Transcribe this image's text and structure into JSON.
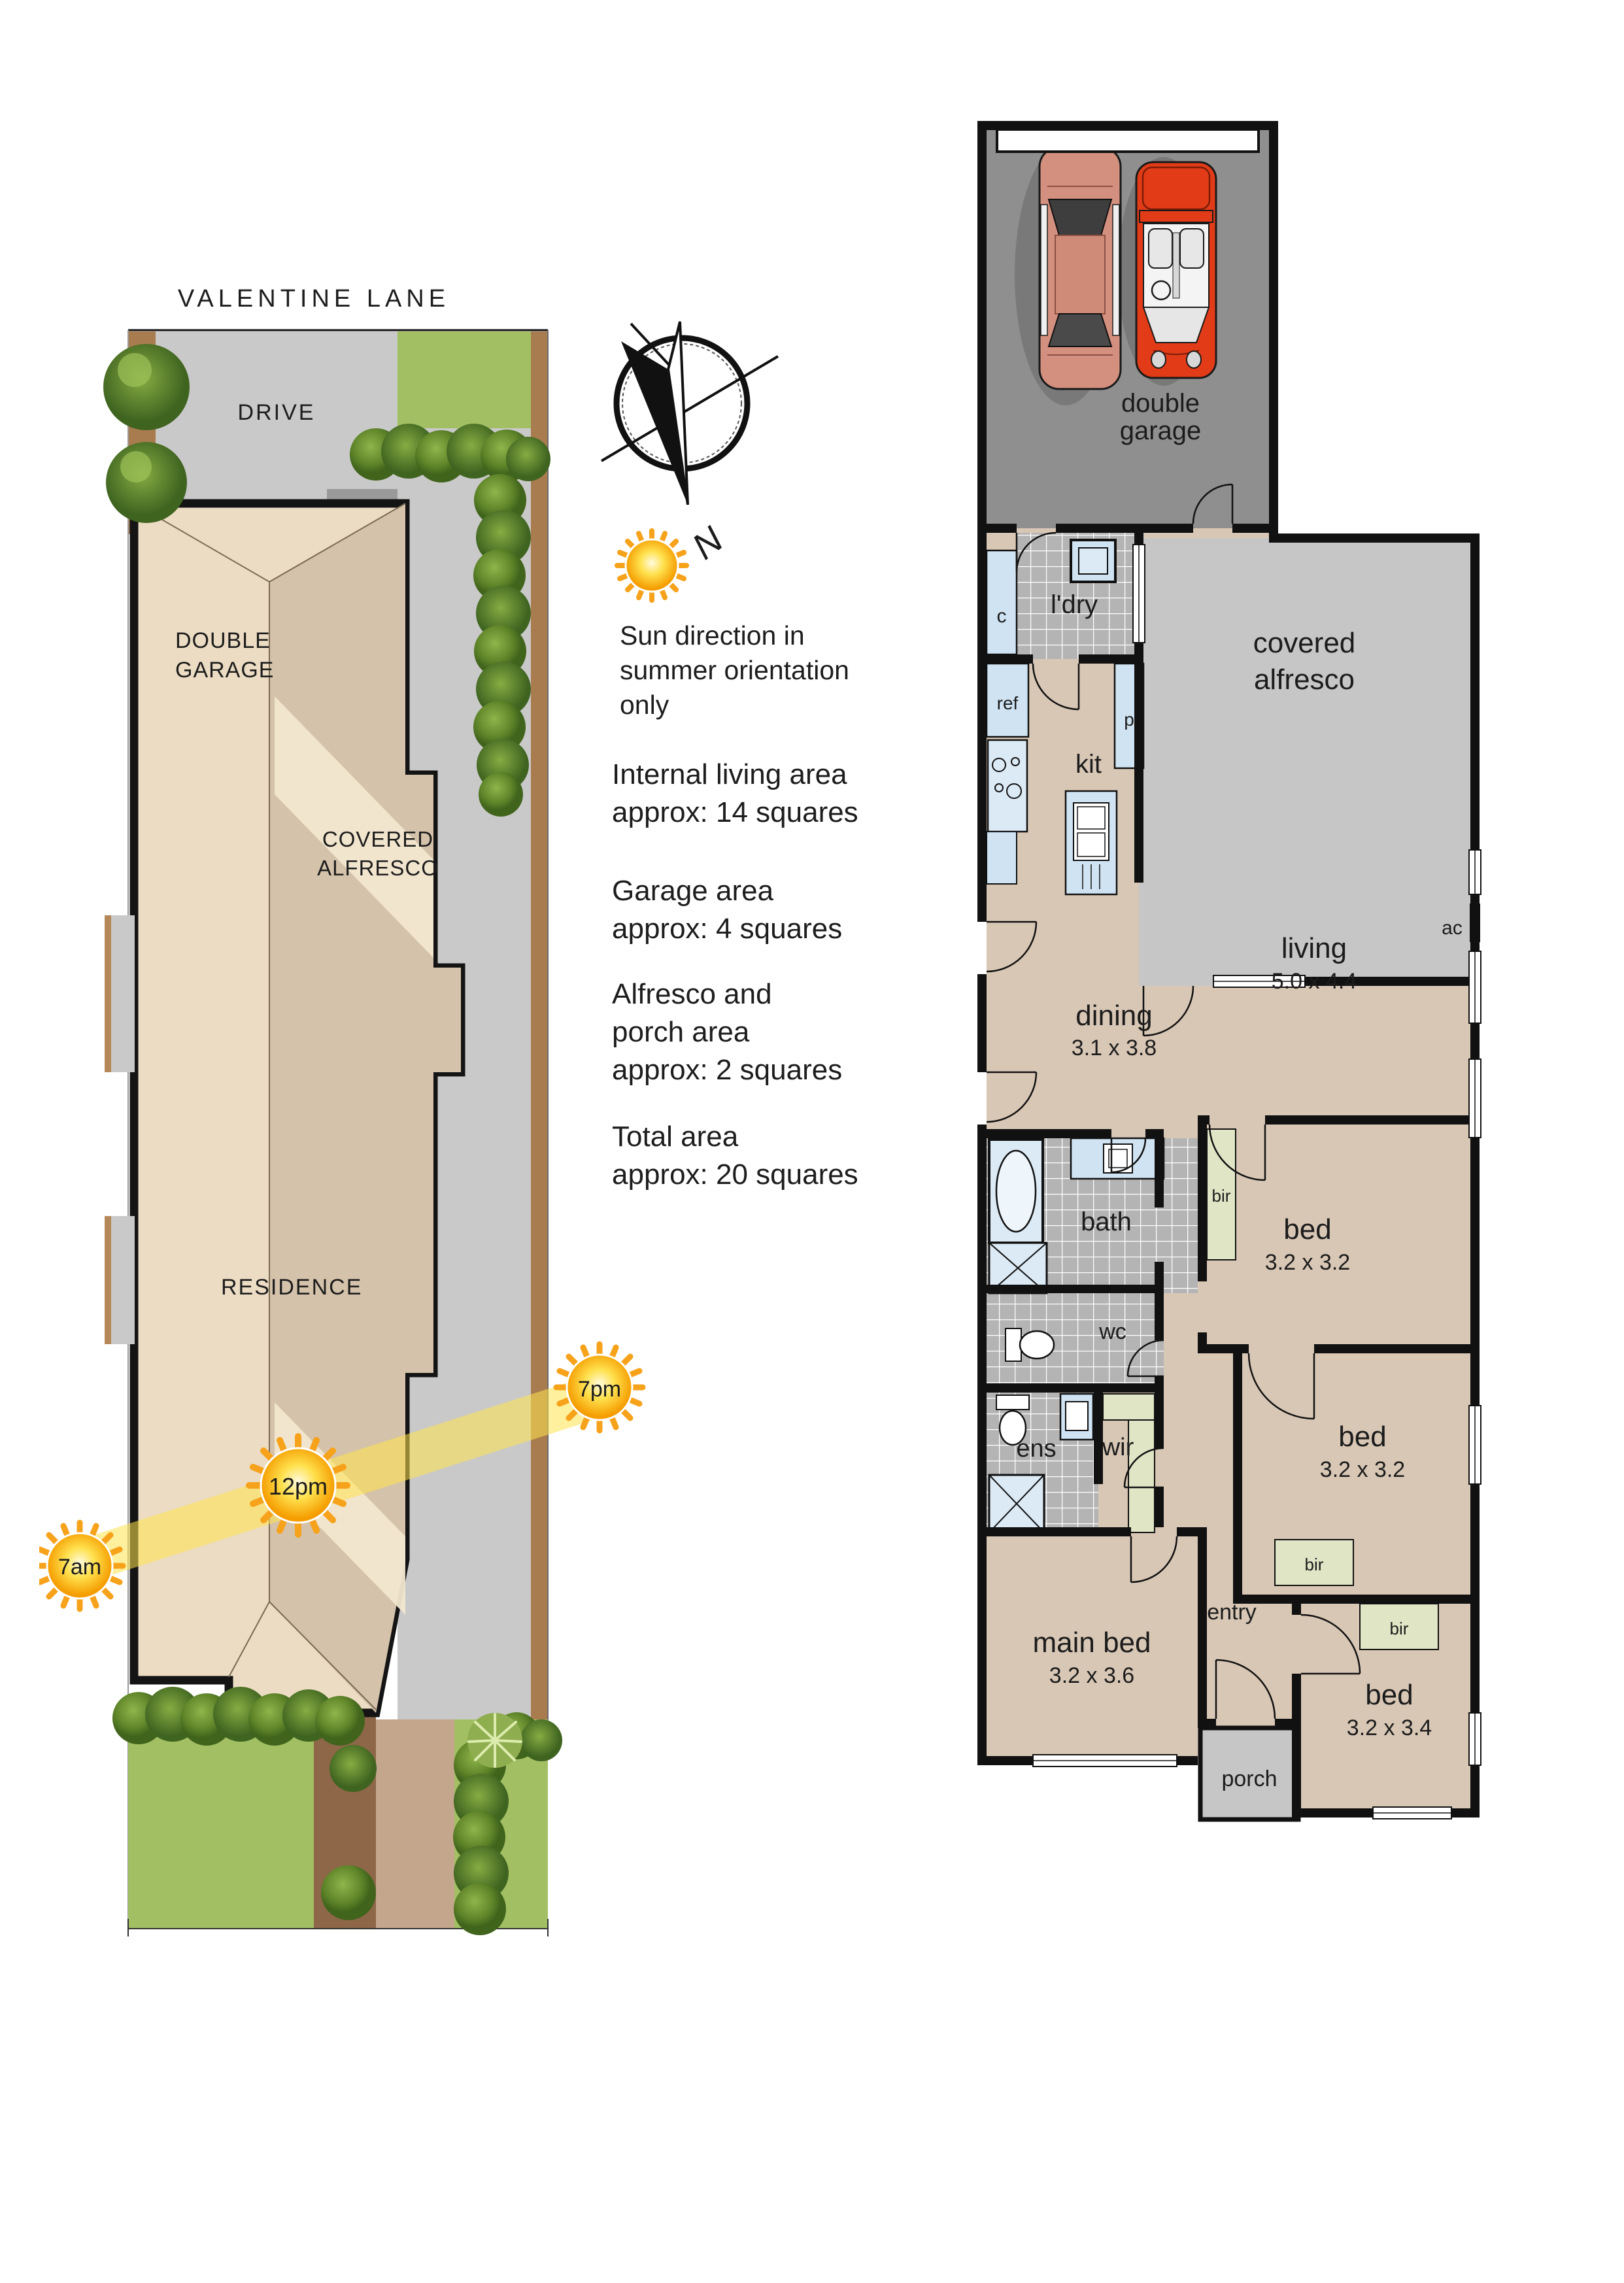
{
  "site": {
    "street": "VALENTINE LANE",
    "drive": "DRIVE",
    "garage_l1": "DOUBLE",
    "garage_l2": "GARAGE",
    "alfresco_l1": "COVERED",
    "alfresco_l2": "ALFRESCO",
    "residence": "RESIDENCE",
    "sun_am": "7am",
    "sun_noon": "12pm",
    "sun_pm": "7pm"
  },
  "legend": {
    "north": "N",
    "note_l1": "Sun direction in",
    "note_l2": "summer orientation",
    "note_l3": "only",
    "stat1_l1": "Internal living area",
    "stat1_l2": "approx: 14 squares",
    "stat2_l1": "Garage area",
    "stat2_l2": "approx: 4 squares",
    "stat3_l1": "Alfresco and",
    "stat3_l2": "porch area",
    "stat3_l3": "approx: 2 squares",
    "stat4_l1": "Total area",
    "stat4_l2": "approx: 20 squares"
  },
  "plan": {
    "garage_l1": "double",
    "garage_l2": "garage",
    "ldry": "l'dry",
    "c": "c",
    "ref": "ref",
    "p": "p",
    "kit": "kit",
    "alfresco_l1": "covered",
    "alfresco_l2": "alfresco",
    "dining": "dining",
    "dining_dims": "3.1 x 3.8",
    "living": "living",
    "living_dims": "5.0 x 4.4",
    "ac": "ac",
    "bath": "bath",
    "wc": "wc",
    "bed1": "bed",
    "bed1_dims": "3.2 x 3.2",
    "bir1": "bir",
    "ens": "ens",
    "wir": "wir",
    "bed2": "bed",
    "bed2_dims": "3.2 x 3.2",
    "bir2": "bir",
    "bir3": "bir",
    "main_bed": "main bed",
    "main_bed_dims": "3.2 x 3.6",
    "entry": "entry",
    "bed3": "bed",
    "bed3_dims": "3.2 x 3.4",
    "porch": "porch"
  },
  "colors": {
    "wall": "#111111",
    "floor": "#d8c7b5",
    "garage_floor": "#8f8f8f",
    "alfresco_floor": "#c6c6c6",
    "tile_floor": "#b4b4b4",
    "fixture_blue": "#cfe3f2",
    "robe_green": "#dfe5c5",
    "lawn_green": "#a2c063",
    "drive_grey": "#c9c9c9",
    "soil_brown": "#a97c50",
    "roof_light": "#ecdcc3",
    "roof_dark": "#d4c2aa",
    "sun_beam": "#ffe34d",
    "car1": "#d4907e",
    "car2": "#e23b17"
  }
}
